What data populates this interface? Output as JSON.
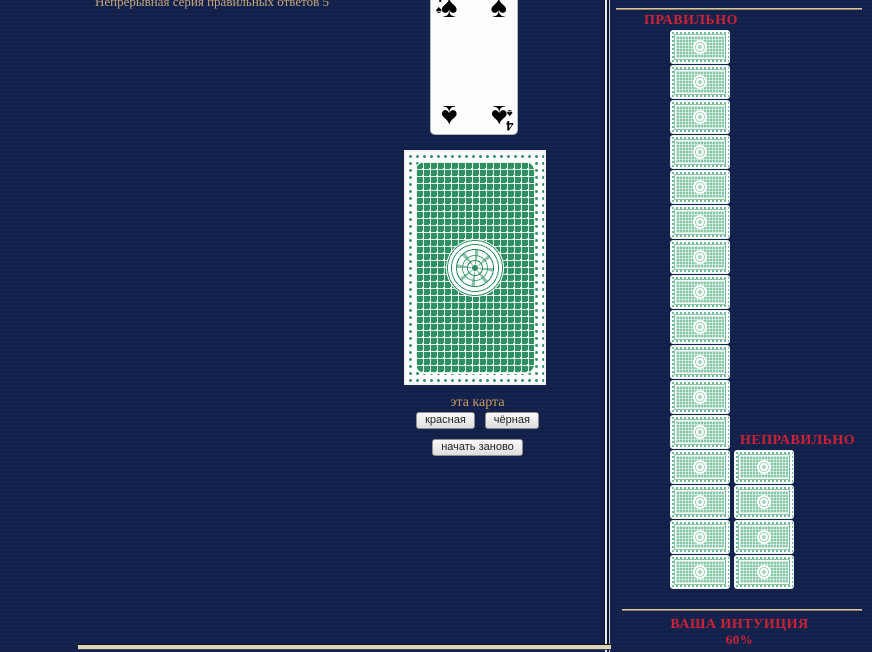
{
  "colors": {
    "background": "#13214d",
    "frame_border": "#ded5b5",
    "red_label": "#cc2233",
    "tan_text": "#c6a678",
    "card_green": "#2e8f62",
    "mini_card_green": "#85c8a5"
  },
  "left_panel": {
    "streak_text": "Непрерывная серия правильных ответов 5"
  },
  "center_panel": {
    "revealed_card": {
      "rank": "4",
      "suit": "spades",
      "suit_symbol": "♠"
    },
    "prompt_label": "эта карта",
    "red_button": "красная",
    "black_button": "чёрная",
    "restart_button": "начать заново"
  },
  "right_panel": {
    "correct_label": "ПРАВИЛЬНО",
    "correct_count": 16,
    "incorrect_label": "НЕПРАВИЛЬНО",
    "incorrect_count": 4,
    "intuition_label": "ВАША ИНТУИЦИЯ",
    "intuition_value": "60%"
  }
}
